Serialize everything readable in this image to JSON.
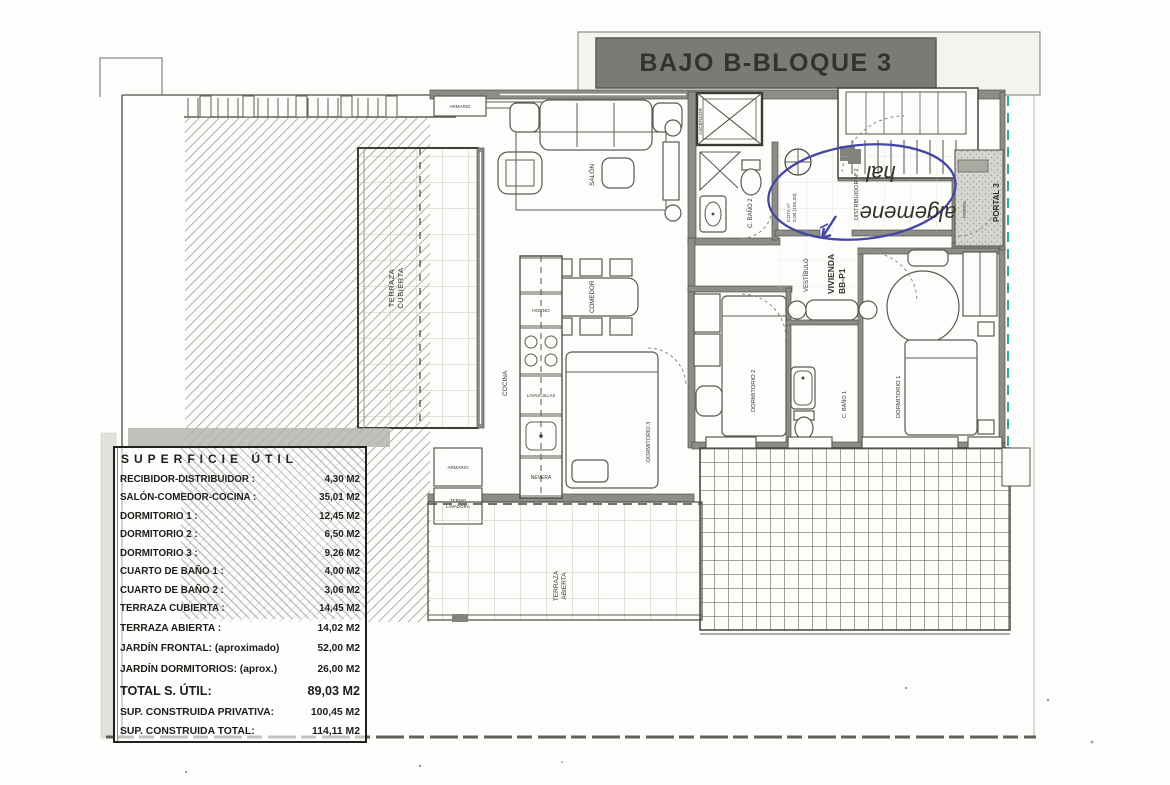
{
  "plan": {
    "banner": "BAJO B-BLOQUE 3",
    "labels": {
      "salon": "SALÓN",
      "comedor": "COMEDOR",
      "cocina": "COCINA",
      "dormitorio1": "DORMITORIO 1",
      "dormitorio2": "DORMITORIO 2",
      "dormitorio3": "DORMITORIO 3",
      "bano1": "C. BAÑO 1",
      "bano2": "C. BAÑO 2",
      "vestibulo": "VESTÍBULO",
      "vivienda1": "VIVIENDA",
      "vivienda2": "BB-P1",
      "distribuidor": "DISTRIBUIDOR Nº 2",
      "cota1": "COTA nº",
      "cota2": "0,00 (102,20)",
      "terraza_c1": "TERRAZA",
      "terraza_c2": "CUBIERTA",
      "terraza_a1": "TERRAZA",
      "terraza_a2": "ABIERTA",
      "portal3": "PORTAL 3",
      "portal": "PORTAL",
      "ascensor": "ASCENSOR",
      "armario": "ARMARIO",
      "termo1": "TERMO",
      "termo2": "LAVADORA",
      "horno": "HORNO",
      "lavavajillas": "LAVAVAJILLAS",
      "nevera": "NEVERA"
    },
    "annotation": {
      "word1": "algemene",
      "word2": "hal",
      "ink_color": "#4547a5"
    },
    "colors": {
      "banner_bg": "#7b7a77",
      "wall": "#8c8c88",
      "teal_dash": "#2fae9f"
    }
  },
  "area_table": {
    "header": "SUPERFICIE ÚTIL",
    "rows": [
      {
        "label": "RECIBIDOR-DISTRIBUIDOR :",
        "value": "4,30 M2"
      },
      {
        "label": "SALÓN-COMEDOR-COCINA :",
        "value": "35,01 M2"
      },
      {
        "label": "DORMITORIO 1 :",
        "value": "12,45 M2"
      },
      {
        "label": "DORMITORIO 2 :",
        "value": "6,50 M2"
      },
      {
        "label": "DORMITORIO 3 :",
        "value": "9,26 M2"
      },
      {
        "label": "CUARTO DE BAÑO 1 :",
        "value": "4,00 M2"
      },
      {
        "label": "CUARTO DE BAÑO 2 :",
        "value": "3,06 M2"
      },
      {
        "label": "TERRAZA CUBIERTA :",
        "value": "14,45 M2"
      },
      {
        "label": "TERRAZA ABIERTA :",
        "value": "14,02 M2"
      },
      {
        "label": "JARDÍN FRONTAL: (aproximado)",
        "value": "52,00 M2"
      },
      {
        "label": "JARDÍN DORMITORIOS: (aprox.)",
        "value": "26,00 M2"
      }
    ],
    "total": {
      "label": "TOTAL S. ÚTIL:",
      "value": "89,03 M2"
    },
    "sup_privativa": {
      "label": "SUP. CONSTRUIDA PRIVATIVA:",
      "value": "100,45 M2"
    },
    "sup_total": {
      "label": "SUP. CONSTRUIDA TOTAL:",
      "value": "114,11 M2"
    }
  }
}
